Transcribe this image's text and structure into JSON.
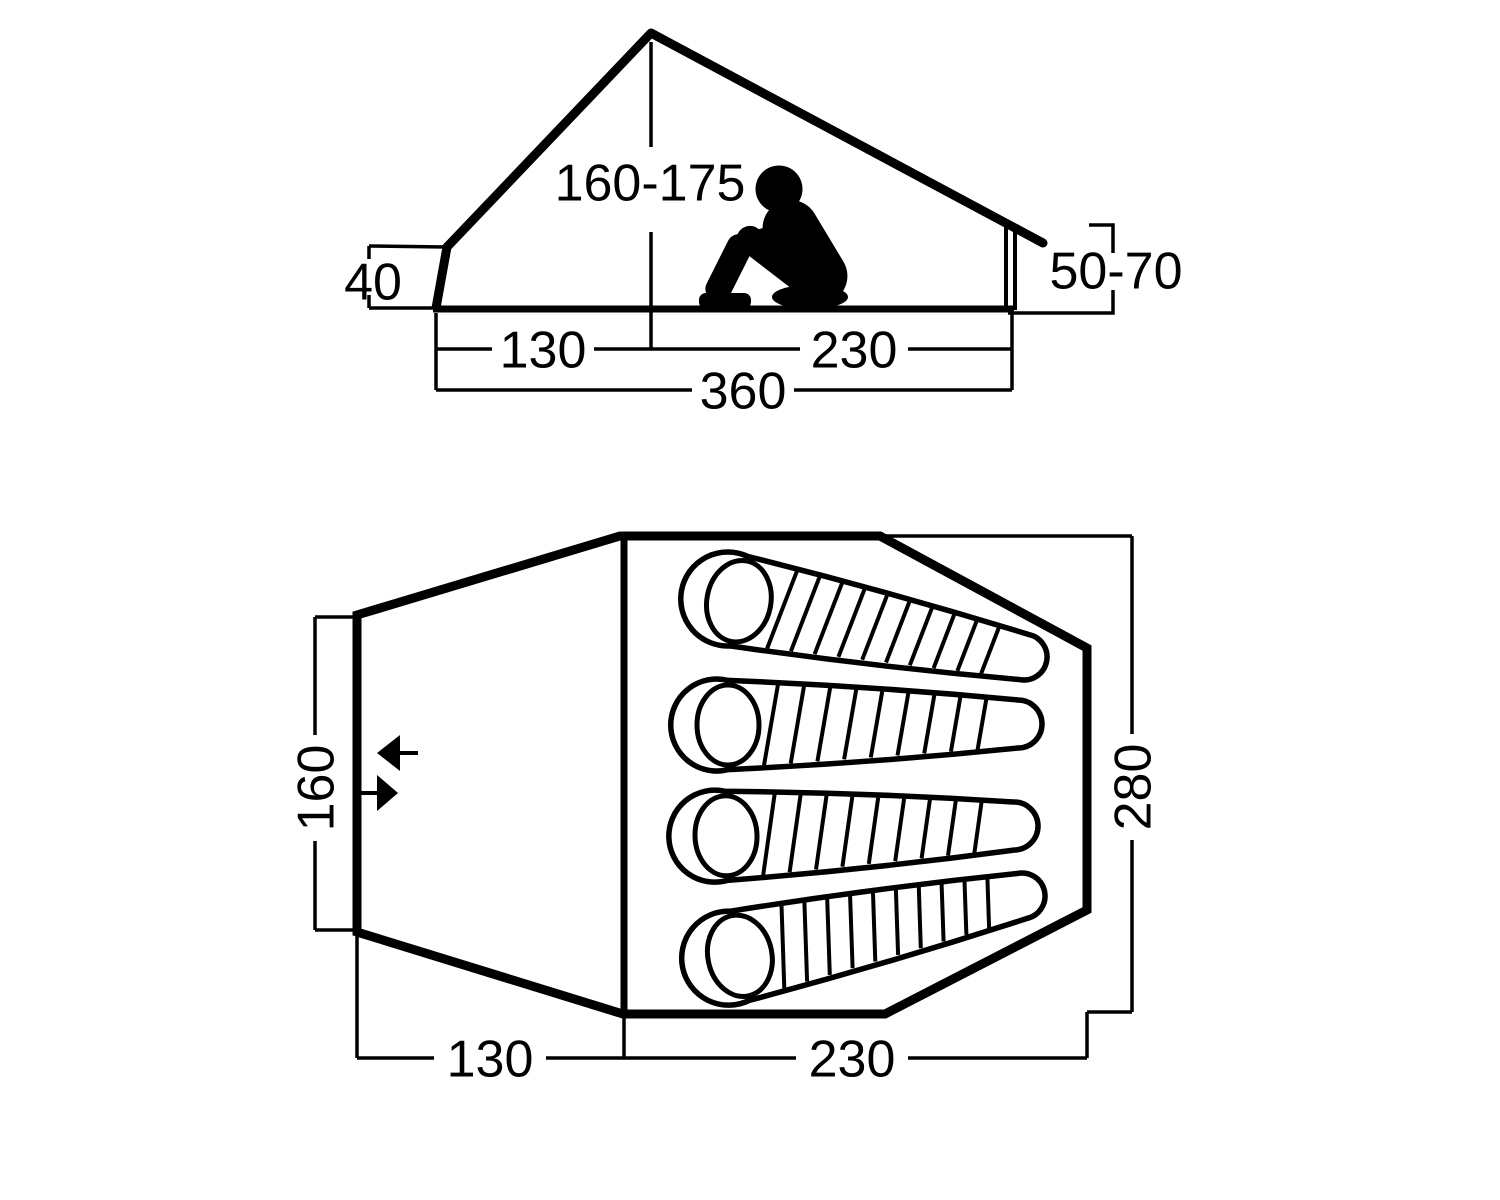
{
  "side_view": {
    "peak_height": "160-175",
    "rear_height": "40",
    "front_wall_height": "50-70",
    "rear_length": "130",
    "main_length": "230",
    "total_length": "360"
  },
  "floor_plan": {
    "vestibule_length": "130",
    "sleeping_area_length": "230",
    "rear_width": "160",
    "sleeping_area_width": "280"
  }
}
